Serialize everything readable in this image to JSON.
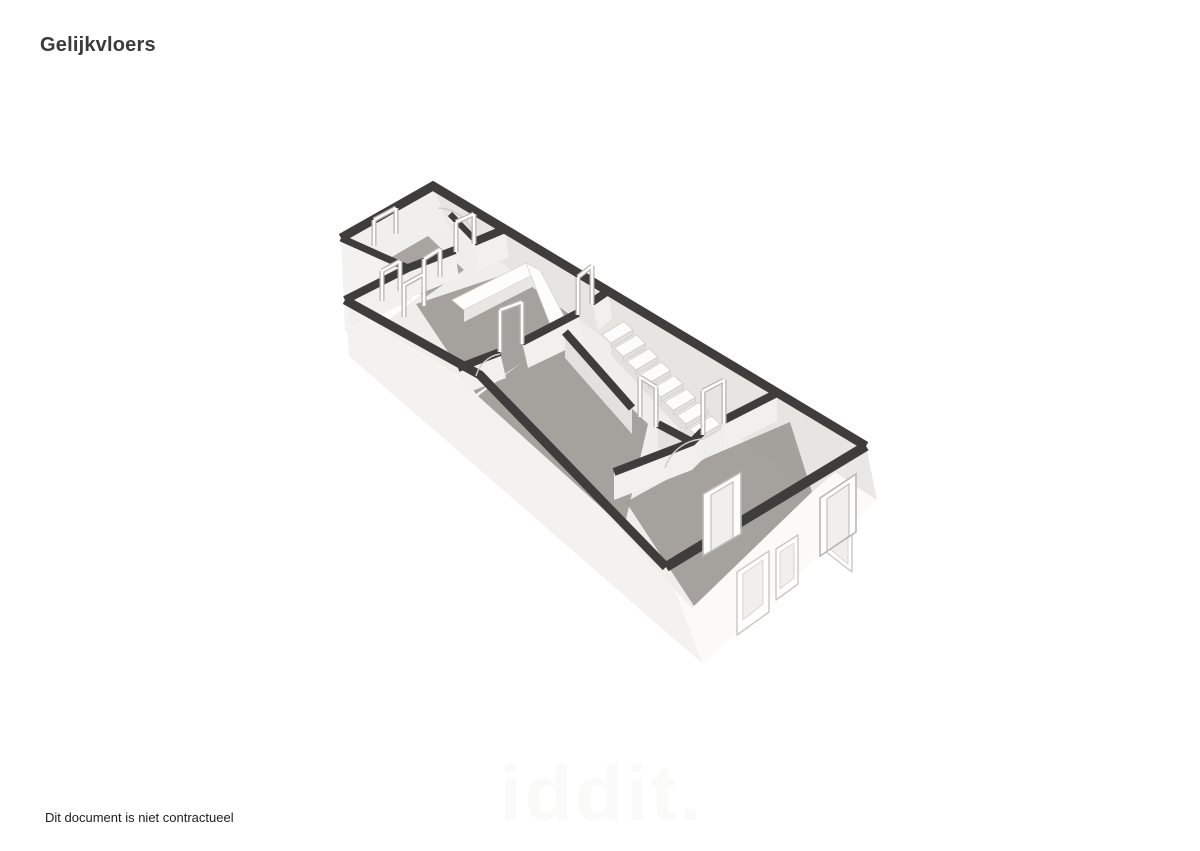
{
  "page": {
    "title": "Gelijkvloers",
    "disclaimer": "Dit document is niet contractueel",
    "watermark": "iddit."
  },
  "floorplan": {
    "label": "3D plattegrond van het gelijkvloers",
    "features": [
      "badkamer",
      "keuken met aanrecht",
      "eetkamer",
      "trap",
      "woonkamer",
      "voorgevel met deur en raam"
    ]
  },
  "theme": {
    "title_color": "#3b3b3b",
    "text_color": "#1d1d1d",
    "watermark_color": "#fafaf9",
    "wall_cap": "#3e3d3b",
    "wall_face_light": "#f3f2ef",
    "wall_face_bright": "#fbfaf8",
    "wall_face_shade": "#eae8e4",
    "inner_wall": "#f1f0ed",
    "inner_wall_shade": "#e3e1dd",
    "floor_light": "#efeeea",
    "floor_gray": "#9e9b96",
    "stair_tread": "#fcfcfb",
    "stair_riser": "#e3e1dd",
    "frame_gray": "#b9b7b3",
    "frame_white": "#fdfdfc"
  }
}
